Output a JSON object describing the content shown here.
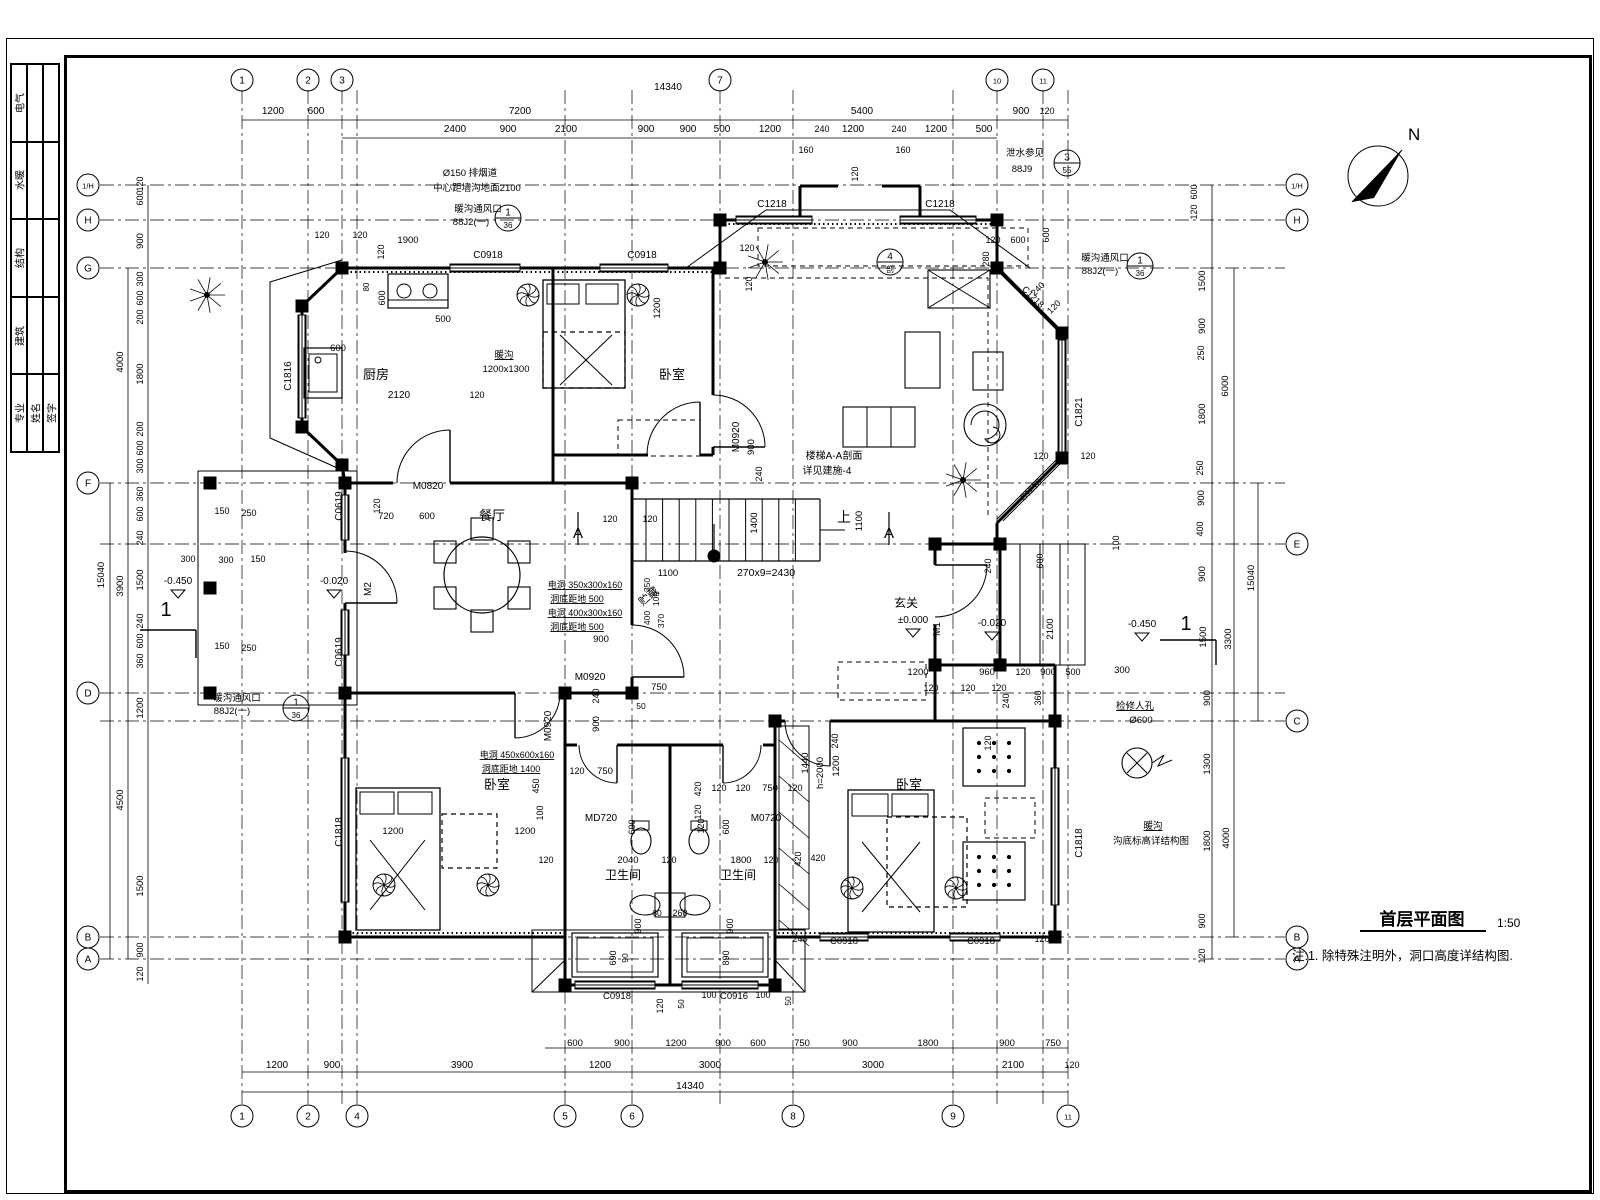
{
  "colors": {
    "line": "#000000",
    "background": "#ffffff"
  },
  "titleblock": {
    "rows": [
      "电气",
      "水暖",
      "结构",
      "建筑"
    ],
    "sign_cols": [
      "专业",
      "姓名",
      "签字"
    ]
  },
  "north": {
    "label": "N"
  },
  "title": {
    "text": "首层平面图",
    "scale": "1:50"
  },
  "note": "注:1. 除特殊注明外，洞口高度详结构图.",
  "axes": {
    "top": [
      {
        "label": "1",
        "x": 242
      },
      {
        "label": "2",
        "x": 308
      },
      {
        "label": "3",
        "x": 342
      },
      {
        "label": "7",
        "x": 720
      },
      {
        "label": "10",
        "x": 997
      },
      {
        "label": "11",
        "x": 1043
      }
    ],
    "bottom": [
      {
        "label": "1",
        "x": 242
      },
      {
        "label": "2",
        "x": 308
      },
      {
        "label": "4",
        "x": 357
      },
      {
        "label": "5",
        "x": 565
      },
      {
        "label": "6",
        "x": 632
      },
      {
        "label": "8",
        "x": 793
      },
      {
        "label": "9",
        "x": 953
      },
      {
        "label": "11",
        "x": 1068
      }
    ],
    "left": [
      {
        "label": "1/H",
        "y": 185
      },
      {
        "label": "H",
        "y": 220
      },
      {
        "label": "G",
        "y": 268
      },
      {
        "label": "F",
        "y": 483
      },
      {
        "label": "D",
        "y": 693
      },
      {
        "label": "B",
        "y": 937
      },
      {
        "label": "A",
        "y": 959
      }
    ],
    "right": [
      {
        "label": "1/H",
        "y": 185
      },
      {
        "label": "H",
        "y": 220
      },
      {
        "label": "E",
        "y": 544
      },
      {
        "label": "C",
        "y": 721
      },
      {
        "label": "B",
        "y": 937
      },
      {
        "label": "A",
        "y": 959
      }
    ]
  },
  "detail_bubbles": [
    {
      "num": "1",
      "ref": "36",
      "x": 508,
      "y": 218
    },
    {
      "num": "3",
      "ref": "55",
      "x": 1067,
      "y": 163
    },
    {
      "num": "1",
      "ref": "36",
      "x": 1140,
      "y": 266
    },
    {
      "num": "1",
      "ref": "36",
      "x": 296,
      "y": 708
    },
    {
      "num": "4",
      "ref": "剖",
      "x": 890,
      "y": 262
    }
  ],
  "annotations": [
    [
      "14340",
      668,
      90
    ],
    [
      "1200",
      273,
      114
    ],
    [
      "600",
      316,
      114
    ],
    [
      "7200",
      520,
      114
    ],
    [
      "5400",
      862,
      114
    ],
    [
      "900",
      1021,
      114
    ],
    [
      "120",
      1047,
      114,
      0,
      9
    ],
    [
      "2400",
      455,
      132
    ],
    [
      "900",
      508,
      132
    ],
    [
      "2100",
      566,
      132
    ],
    [
      "900",
      646,
      132
    ],
    [
      "900",
      688,
      132
    ],
    [
      "500",
      722,
      132
    ],
    [
      "1200",
      770,
      132
    ],
    [
      "240",
      822,
      132,
      0,
      9
    ],
    [
      "1200",
      853,
      132
    ],
    [
      "240",
      899,
      132,
      0,
      9
    ],
    [
      "1200",
      936,
      132
    ],
    [
      "500",
      984,
      132
    ],
    [
      "160",
      806,
      153,
      0,
      9
    ],
    [
      "160",
      903,
      153,
      0,
      9
    ],
    [
      "120",
      858,
      174,
      -90,
      9
    ],
    [
      "Ø150 排烟道",
      470,
      176,
      0,
      9.5
    ],
    [
      "中心距墙沟地面2100",
      477,
      191,
      0,
      9.5
    ],
    [
      "暖沟通风口",
      478,
      212,
      0,
      9.5
    ],
    [
      "88J2(一)",
      471,
      225,
      0,
      9.5
    ],
    [
      "泄水参见",
      1025,
      156,
      0,
      9.5
    ],
    [
      "88J9",
      1022,
      172,
      0,
      9.5
    ],
    [
      "暖沟通风口",
      1105,
      261,
      0,
      9.5
    ],
    [
      "88J2(一)",
      1100,
      274,
      0,
      9.5
    ],
    [
      "C0918",
      488,
      258,
      0,
      10
    ],
    [
      "C0918",
      642,
      258,
      0,
      10
    ],
    [
      "C1218",
      772,
      207,
      0,
      10
    ],
    [
      "C1218",
      940,
      207,
      0,
      10
    ],
    [
      "120",
      322,
      238,
      0,
      9
    ],
    [
      "120",
      360,
      238,
      0,
      9
    ],
    [
      "1900",
      408,
      243,
      0,
      9.5
    ],
    [
      "120",
      384,
      252,
      -90,
      9
    ],
    [
      "120",
      993,
      243,
      0,
      9
    ],
    [
      "600",
      1018,
      243,
      0,
      9
    ],
    [
      "600",
      1049,
      235,
      -90,
      9
    ],
    [
      "280",
      989,
      259,
      -90,
      9
    ],
    [
      "240",
      1040,
      291,
      -45,
      9
    ],
    [
      "120",
      1056,
      309,
      -45,
      9
    ],
    [
      "120",
      747,
      251,
      0,
      9
    ],
    [
      "120",
      752,
      284,
      -90,
      9
    ],
    [
      "120",
      143,
      184,
      -90,
      9
    ],
    [
      "600",
      143,
      198,
      -90,
      9
    ],
    [
      "900",
      143,
      241,
      -90,
      9.5
    ],
    [
      "300",
      143,
      279,
      -90,
      9
    ],
    [
      "600",
      143,
      298,
      -90,
      9
    ],
    [
      "200",
      143,
      317,
      -90,
      9
    ],
    [
      "1800",
      143,
      374,
      -90,
      9.5
    ],
    [
      "200",
      143,
      429,
      -90,
      9
    ],
    [
      "600",
      143,
      448,
      -90,
      9
    ],
    [
      "300",
      143,
      466,
      -90,
      9
    ],
    [
      "4000",
      123,
      362,
      -90,
      9.5
    ],
    [
      "15040",
      104,
      575,
      -90,
      9.5
    ],
    [
      "3900",
      123,
      586,
      -90,
      9.5
    ],
    [
      "360",
      143,
      494,
      -90,
      9
    ],
    [
      "600",
      143,
      514,
      -90,
      9
    ],
    [
      "240",
      143,
      538,
      -90,
      9
    ],
    [
      "1500",
      143,
      580,
      -90,
      9.5
    ],
    [
      "240",
      143,
      621,
      -90,
      9
    ],
    [
      "600",
      143,
      641,
      -90,
      9
    ],
    [
      "360",
      143,
      661,
      -90,
      9
    ],
    [
      "1200",
      143,
      708,
      -90,
      9.5
    ],
    [
      "4500",
      123,
      800,
      -90,
      9.5
    ],
    [
      "1500",
      143,
      886,
      -90,
      9.5
    ],
    [
      "900",
      143,
      950,
      -90,
      9
    ],
    [
      "120",
      143,
      974,
      -90,
      9
    ],
    [
      "150",
      222,
      514,
      0,
      9
    ],
    [
      "250",
      249,
      516,
      0,
      9
    ],
    [
      "300",
      188,
      562,
      0,
      9
    ],
    [
      "300",
      226,
      563,
      0,
      9
    ],
    [
      "150",
      258,
      562,
      0,
      9
    ],
    [
      "-0.450",
      178,
      584,
      0,
      10
    ],
    [
      "-0.020",
      334,
      584,
      0,
      10
    ],
    [
      "150",
      222,
      649,
      0,
      9
    ],
    [
      "250",
      249,
      651,
      0,
      9
    ],
    [
      "1",
      166,
      616,
      0,
      20
    ],
    [
      "暖沟通风口",
      237,
      701,
      0,
      9.5
    ],
    [
      "88J2(一)",
      232,
      714,
      0,
      9.5
    ],
    [
      "厨房",
      376,
      379,
      0,
      13
    ],
    [
      "500",
      443,
      322,
      0,
      9.5
    ],
    [
      "80",
      369,
      287,
      -90,
      8
    ],
    [
      "600",
      385,
      298,
      -90,
      9
    ],
    [
      "600",
      338,
      351,
      0,
      9.5
    ],
    [
      "2120",
      399,
      398,
      0,
      10
    ],
    [
      "120",
      477,
      398,
      0,
      9
    ],
    [
      "C1816",
      291,
      376,
      -90,
      10
    ],
    [
      "暖沟",
      504,
      358,
      0,
      9.5,
      "u"
    ],
    [
      "1200x1300",
      506,
      372,
      0,
      9.5
    ],
    [
      "卧室",
      672,
      379,
      0,
      13
    ],
    [
      "1200",
      660,
      308,
      -90,
      9.5
    ],
    [
      "餐厅",
      492,
      520,
      0,
      13
    ],
    [
      "M0820",
      428,
      489,
      0,
      10
    ],
    [
      "720",
      386,
      519,
      0,
      9.5
    ],
    [
      "600",
      427,
      519,
      0,
      9.5
    ],
    [
      "120",
      380,
      506,
      -90,
      9
    ],
    [
      "M2",
      371,
      589,
      -90,
      10
    ],
    [
      "C0619",
      342,
      506,
      -90,
      10
    ],
    [
      "C0619",
      342,
      652,
      -90,
      10
    ],
    [
      "120",
      610,
      522,
      0,
      9
    ],
    [
      "120",
      650,
      522,
      0,
      9
    ],
    [
      "1100",
      668,
      576,
      0,
      9.5
    ],
    [
      "270x9=2430",
      766,
      576,
      0,
      10.5
    ],
    [
      "1400",
      757,
      523,
      -90,
      9.5
    ],
    [
      "上",
      844,
      522,
      0,
      14
    ],
    [
      "1100",
      862,
      521,
      -90,
      9.5
    ],
    [
      "A",
      578,
      538,
      0,
      15
    ],
    [
      "A",
      889,
      538,
      0,
      15
    ],
    [
      "楼梯A-A剖面",
      834,
      459,
      0,
      10
    ],
    [
      "详见建施-4",
      827,
      474,
      0,
      10
    ],
    [
      "M0920",
      739,
      437,
      -90,
      10
    ],
    [
      "900",
      754,
      447,
      -90,
      9.5
    ],
    [
      "240",
      762,
      474,
      -90,
      9
    ],
    [
      "贮藏",
      651,
      599,
      -40,
      11
    ],
    [
      "电洞 350x300x160",
      585,
      588,
      0,
      9,
      "u"
    ],
    [
      "洞底距地 500",
      577,
      602,
      0,
      9,
      "u"
    ],
    [
      "电洞 400x300x160",
      585,
      616,
      0,
      9,
      "u"
    ],
    [
      "洞底距地 500",
      577,
      630,
      0,
      9,
      "u"
    ],
    [
      "900",
      601,
      642,
      0,
      9.5
    ],
    [
      "350",
      650,
      585,
      -90,
      8.5
    ],
    [
      "100",
      659,
      599,
      -90,
      8.5
    ],
    [
      "400",
      650,
      618,
      -90,
      8.5
    ],
    [
      "370",
      664,
      621,
      -90,
      8.5
    ],
    [
      "M0920",
      590,
      680,
      0,
      10
    ],
    [
      "750",
      659,
      690,
      0,
      9.5
    ],
    [
      "玄关",
      906,
      607,
      0,
      12
    ],
    [
      "±0.000",
      913,
      623,
      0,
      10
    ],
    [
      "M1",
      940,
      629,
      -90,
      10
    ],
    [
      "-0.020",
      992,
      626,
      0,
      10
    ],
    [
      "-0.450",
      1142,
      627,
      0,
      10
    ],
    [
      "1",
      1186,
      630,
      0,
      20
    ],
    [
      "2100",
      1053,
      629,
      -90,
      9.5
    ],
    [
      "240",
      991,
      566,
      -90,
      9
    ],
    [
      "600",
      1043,
      561,
      -90,
      9
    ],
    [
      "100",
      1119,
      543,
      -90,
      9
    ],
    [
      "1200",
      918,
      675,
      0,
      9.5
    ],
    [
      "960",
      987,
      675,
      0,
      9.5
    ],
    [
      "120",
      1023,
      675,
      0,
      9
    ],
    [
      "900",
      1048,
      675,
      0,
      9.5
    ],
    [
      "500",
      1073,
      675,
      0,
      9
    ],
    [
      "300",
      1122,
      673,
      0,
      9.5
    ],
    [
      "120",
      931,
      691,
      0,
      9
    ],
    [
      "120",
      968,
      691,
      0,
      9
    ],
    [
      "120",
      999,
      691,
      0,
      9
    ],
    [
      "240",
      1009,
      701,
      -90,
      9
    ],
    [
      "360",
      1041,
      698,
      -90,
      9
    ],
    [
      "600",
      1197,
      192,
      -90,
      9
    ],
    [
      "120",
      1197,
      212,
      -90,
      9
    ],
    [
      "1500",
      1205,
      281,
      -90,
      9.5
    ],
    [
      "900",
      1205,
      326,
      -90,
      9.5
    ],
    [
      "250",
      1204,
      353,
      -90,
      9
    ],
    [
      "6000",
      1228,
      386,
      -90,
      9.5
    ],
    [
      "1800",
      1205,
      414,
      -90,
      9.5
    ],
    [
      "250",
      1203,
      468,
      -90,
      9
    ],
    [
      "900",
      1204,
      498,
      -90,
      9.5
    ],
    [
      "400",
      1203,
      529,
      -90,
      9
    ],
    [
      "900",
      1205,
      574,
      -90,
      9.5
    ],
    [
      "15040",
      1254,
      578,
      -90,
      9.5
    ],
    [
      "3300",
      1231,
      639,
      -90,
      9.5
    ],
    [
      "1500",
      1206,
      637,
      -90,
      9.5
    ],
    [
      "900",
      1210,
      698,
      -90,
      9.5
    ],
    [
      "1300",
      1210,
      764,
      -90,
      9.5
    ],
    [
      "1800",
      1210,
      841,
      -90,
      9.5
    ],
    [
      "4000",
      1229,
      838,
      -90,
      9.5
    ],
    [
      "900",
      1205,
      921,
      -90,
      9
    ],
    [
      "120",
      1205,
      956,
      -90,
      9
    ],
    [
      "检修人孔",
      1135,
      709,
      0,
      9.5,
      "u"
    ],
    [
      "Ø600",
      1141,
      723,
      0,
      9.5
    ],
    [
      "暖沟",
      1153,
      829,
      0,
      9.5,
      "u"
    ],
    [
      "沟底标高详结构图",
      1151,
      844,
      0,
      9.5
    ],
    [
      "C1821",
      1082,
      412,
      -90,
      10
    ],
    [
      "C1218",
      1031,
      299,
      45,
      9
    ],
    [
      "C1218",
      1033,
      492,
      -45,
      9
    ],
    [
      "120",
      1041,
      459,
      0,
      9
    ],
    [
      "120",
      1088,
      459,
      0,
      9
    ],
    [
      "C1818",
      1082,
      843,
      -90,
      10
    ],
    [
      "卧室",
      497,
      789,
      0,
      13
    ],
    [
      "电洞 450x600x160",
      517,
      758,
      0,
      9,
      "u"
    ],
    [
      "洞底距地 1400",
      511,
      772,
      0,
      9,
      "u"
    ],
    [
      "C1818",
      342,
      832,
      -90,
      10
    ],
    [
      "1200",
      393,
      834,
      0,
      9.5
    ],
    [
      "1200",
      525,
      834,
      0,
      9.5
    ],
    [
      "450",
      539,
      786,
      -90,
      9
    ],
    [
      "100",
      543,
      813,
      -90,
      9
    ],
    [
      "M0920",
      551,
      726,
      -90,
      10
    ],
    [
      "240",
      599,
      696,
      -90,
      9
    ],
    [
      "900",
      599,
      724,
      -90,
      9.5
    ],
    [
      "50",
      641,
      709,
      0,
      8.5
    ],
    [
      "120",
      577,
      774,
      0,
      9
    ],
    [
      "750",
      605,
      774,
      0,
      9.5
    ],
    [
      "420",
      701,
      789,
      -90,
      9
    ],
    [
      "120",
      701,
      812,
      -90,
      9
    ],
    [
      "120",
      719,
      791,
      0,
      9
    ],
    [
      "120",
      743,
      791,
      0,
      9
    ],
    [
      "750",
      770,
      791,
      0,
      9.5
    ],
    [
      "120",
      795,
      791,
      0,
      9
    ],
    [
      "MD720",
      601,
      821,
      0,
      10
    ],
    [
      "M0720",
      766,
      821,
      0,
      10
    ],
    [
      "600",
      635,
      827,
      -90,
      9
    ],
    [
      "120",
      704,
      826,
      -90,
      9
    ],
    [
      "600",
      729,
      827,
      -90,
      9
    ],
    [
      "卫生间",
      623,
      879,
      0,
      12
    ],
    [
      "卫生间",
      738,
      879,
      0,
      12
    ],
    [
      "120",
      546,
      863,
      0,
      9
    ],
    [
      "2040",
      628,
      863,
      0,
      9.5
    ],
    [
      "120",
      669,
      863,
      0,
      9
    ],
    [
      "1800",
      741,
      863,
      0,
      9.5
    ],
    [
      "120",
      771,
      863,
      0,
      9
    ],
    [
      "420",
      801,
      859,
      -90,
      9
    ],
    [
      "60",
      657,
      916,
      0,
      8.5
    ],
    [
      "260",
      680,
      916,
      0,
      9
    ],
    [
      "900",
      641,
      926,
      -90,
      9
    ],
    [
      "900",
      733,
      926,
      -90,
      9
    ],
    [
      "690",
      616,
      958,
      -90,
      9
    ],
    [
      "90",
      628,
      958,
      -90,
      8.5
    ],
    [
      "890",
      729,
      958,
      -90,
      9
    ],
    [
      "C0918",
      617,
      999,
      0,
      9.5
    ],
    [
      "C0916",
      734,
      999,
      0,
      9.5
    ],
    [
      "120",
      663,
      1006,
      -90,
      9
    ],
    [
      "50",
      684,
      1004,
      -90,
      8.5
    ],
    [
      "100",
      709,
      998,
      0,
      9
    ],
    [
      "100",
      763,
      998,
      0,
      9
    ],
    [
      "50",
      791,
      1001,
      -90,
      8.5
    ],
    [
      "卧室",
      909,
      789,
      0,
      13
    ],
    [
      "h=2000",
      823,
      773,
      -90,
      9.5
    ],
    [
      "1440",
      808,
      763,
      -90,
      9.5
    ],
    [
      "1200",
      839,
      766,
      -90,
      9.5
    ],
    [
      "240",
      838,
      741,
      -90,
      9
    ],
    [
      "120",
      991,
      743,
      -90,
      9
    ],
    [
      "420",
      818,
      861,
      0,
      9
    ],
    [
      "240",
      800,
      942,
      0,
      9
    ],
    [
      "C0918",
      844,
      944,
      0,
      9.5
    ],
    [
      "C0918",
      981,
      944,
      0,
      9.5
    ],
    [
      "120",
      1042,
      942,
      0,
      9
    ],
    [
      "600",
      575,
      1046,
      0,
      9.5
    ],
    [
      "900",
      622,
      1046,
      0,
      9.5
    ],
    [
      "1200",
      676,
      1046,
      0,
      9.5
    ],
    [
      "900",
      723,
      1046,
      0,
      9.5
    ],
    [
      "600",
      758,
      1046,
      0,
      9.5
    ],
    [
      "750",
      802,
      1046,
      0,
      9.5
    ],
    [
      "900",
      850,
      1046,
      0,
      9.5
    ],
    [
      "1800",
      928,
      1046,
      0,
      9.5
    ],
    [
      "900",
      1007,
      1046,
      0,
      9.5
    ],
    [
      "750",
      1053,
      1046,
      0,
      9.5
    ],
    [
      "1200",
      277,
      1068
    ],
    [
      "900",
      332,
      1068
    ],
    [
      "3900",
      462,
      1068
    ],
    [
      "1200",
      600,
      1068
    ],
    [
      "3000",
      710,
      1068
    ],
    [
      "3000",
      873,
      1068
    ],
    [
      "2100",
      1013,
      1068
    ],
    [
      "120",
      1072,
      1068,
      0,
      9
    ],
    [
      "14340",
      690,
      1089
    ]
  ]
}
